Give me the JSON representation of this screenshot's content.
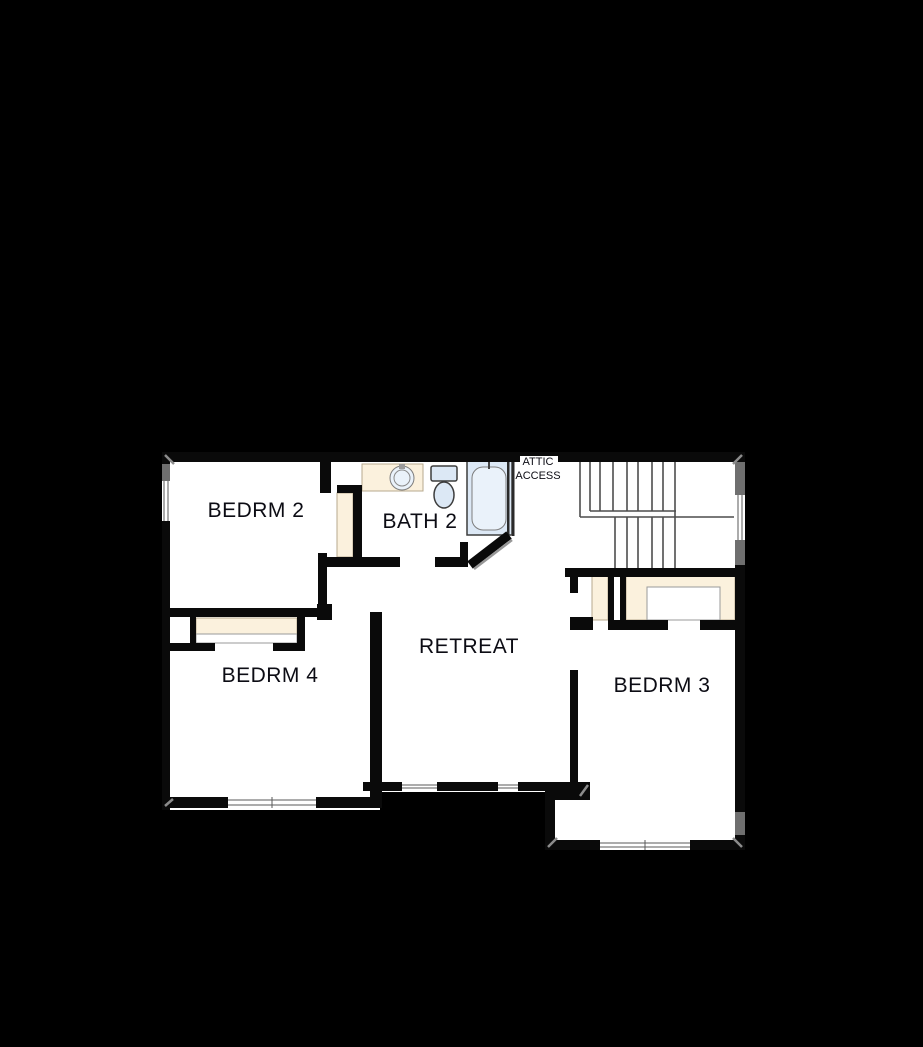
{
  "plan": {
    "title": "second-floor-plan",
    "rooms": [
      {
        "id": "bedrm2",
        "label": "BEDRM 2"
      },
      {
        "id": "bath2",
        "label": "BATH 2"
      },
      {
        "id": "bedrm4",
        "label": "BEDRM 4"
      },
      {
        "id": "retreat",
        "label": "RETREAT"
      },
      {
        "id": "bedrm3",
        "label": "BEDRM 3"
      }
    ],
    "annotations": {
      "attic_line1": "ATTIC",
      "attic_line2": "ACCESS"
    },
    "features": {
      "staircase": "u-shaped-stairs",
      "fixtures": [
        "sink",
        "toilet",
        "bathtub"
      ],
      "closets": [
        "bedrm2-closet",
        "bedrm4-closet",
        "hall-linen-closet",
        "bedrm3-closet"
      ]
    },
    "colors": {
      "background": "#000000",
      "floor": "#ffffff",
      "wall": "#0a0a0a",
      "closet_fill": "#fbf1dd",
      "fixture_fill": "#dce8f5",
      "window_gray": "#6f6f6f",
      "stair_line": "#4d4d4d"
    }
  }
}
